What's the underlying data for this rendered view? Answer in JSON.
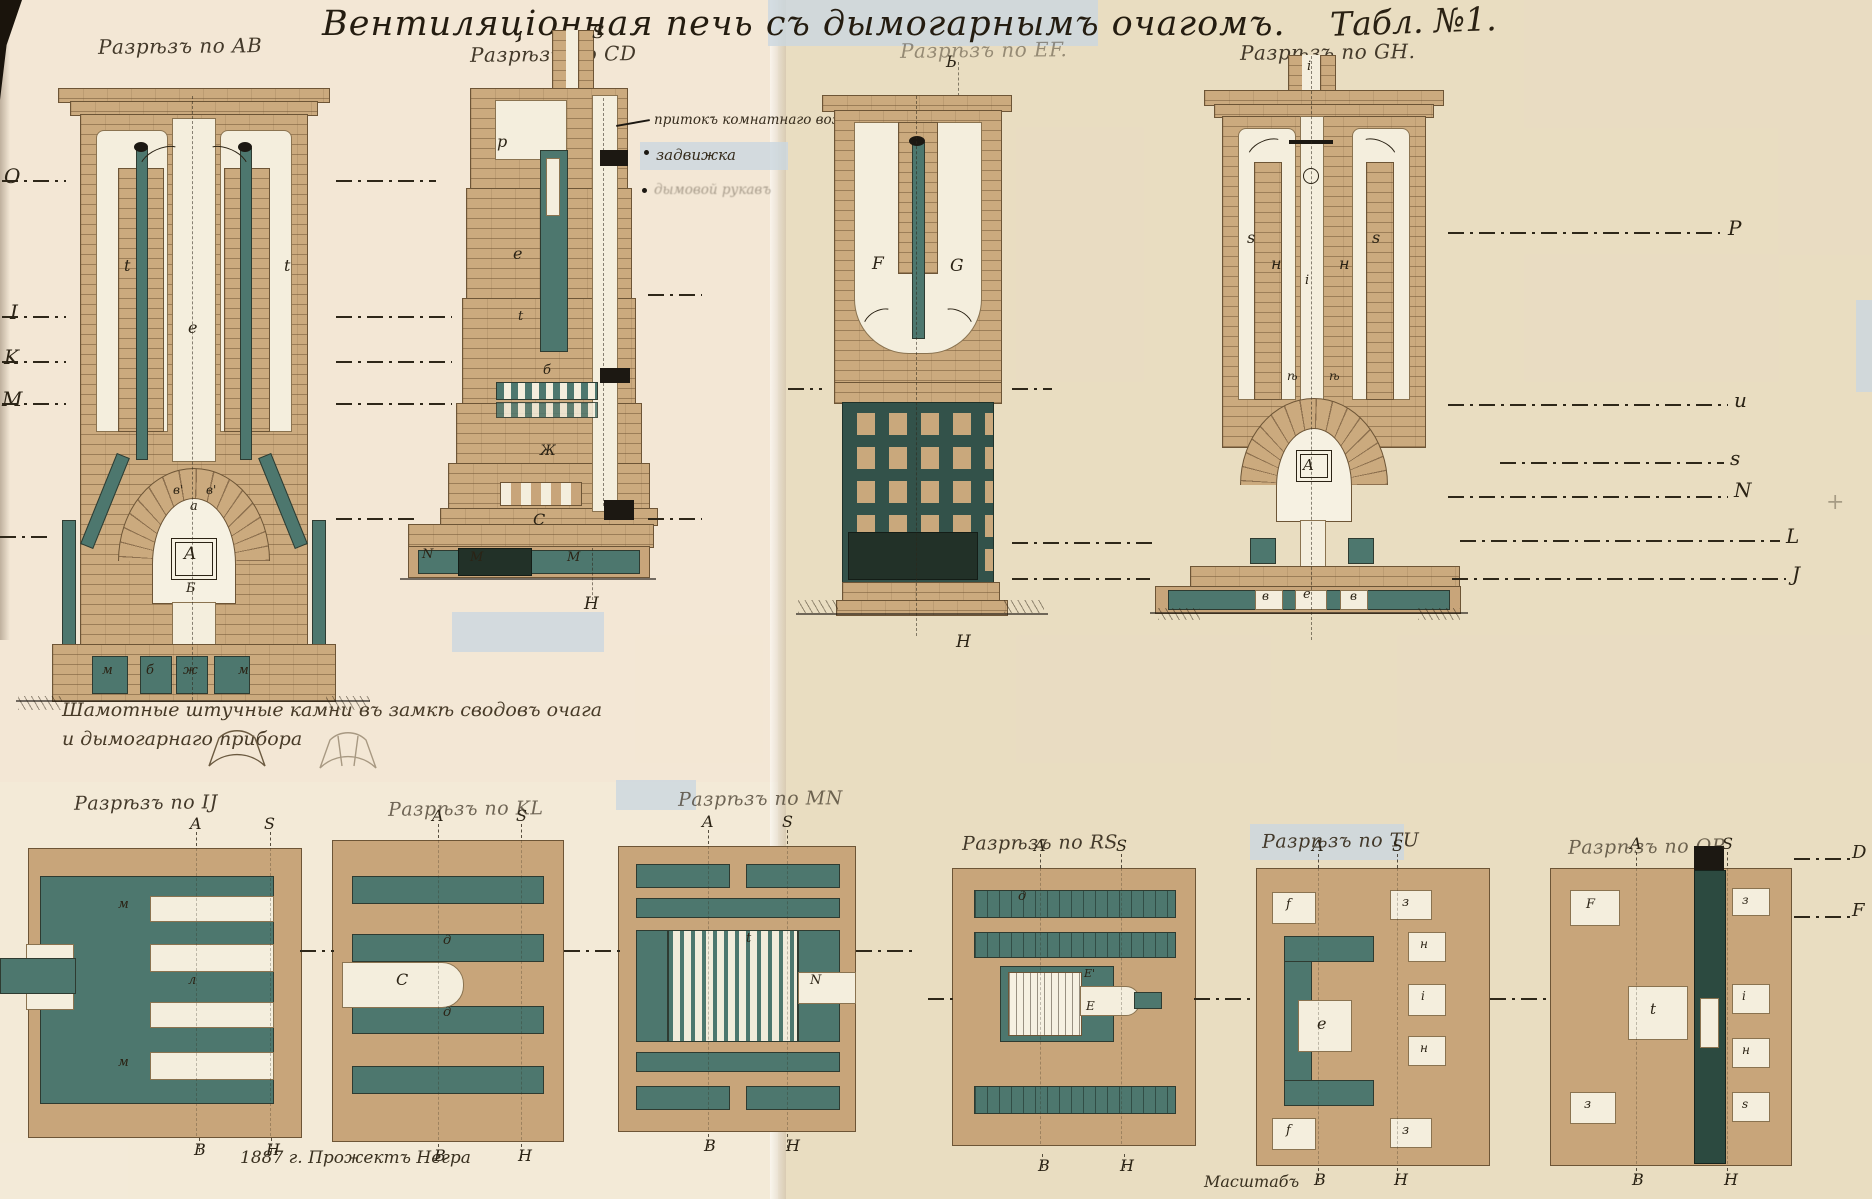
{
  "title": "Вентиляціонная печь съ дымогарнымъ очагомъ.",
  "plate": "Табл. №1.",
  "sections": {
    "ab": "Разрѣзъ по AB",
    "cd": "Разрѣзъ по CD",
    "ef": "Разрѣзъ по EF.",
    "gh": "Разрѣзъ по GH.",
    "ij": "Разрѣзъ по IJ",
    "kl": "Разрѣзъ по KL",
    "mn": "Разрѣзъ по MN",
    "rs": "Разрѣзъ по RS",
    "tu": "Разрѣзъ по TU",
    "op": "Разрѣзъ по OP"
  },
  "annotations": {
    "air_inlet": "притокъ комнатнаго воздуха",
    "damper": "задвижка",
    "smoke_duct": "дымовой рукавъ"
  },
  "notes": {
    "fireclay": "Шамотные штучные камни въ замкѣ сводовъ очага и дымогарнаго прибора",
    "credit": "1887 г. Прожектъ Негра",
    "scale": "Масштабъ"
  },
  "colors": {
    "paper": "#eee3cd",
    "brick": "#cbaa7e",
    "brick_line": "#6d5536",
    "flue_teal": "#4d776e",
    "dark_green": "#33524a",
    "near_black": "#1d2f27",
    "white_channel": "#f4eedd",
    "ink": "#2e2719",
    "highlight_blue": "#cad7e0"
  },
  "glyphs": [
    {
      "t": "O",
      "x": 4,
      "y": 166,
      "s": 20
    },
    {
      "t": "I",
      "x": 10,
      "y": 302,
      "s": 20
    },
    {
      "t": "K",
      "x": 4,
      "y": 347,
      "s": 20
    },
    {
      "t": "M",
      "x": 2,
      "y": 389,
      "s": 20
    },
    {
      "t": "P",
      "x": 1728,
      "y": 218,
      "s": 20
    },
    {
      "t": "u",
      "x": 1734,
      "y": 390,
      "s": 20
    },
    {
      "t": "s",
      "x": 1730,
      "y": 448,
      "s": 20
    },
    {
      "t": "N",
      "x": 1734,
      "y": 480,
      "s": 20
    },
    {
      "t": "L",
      "x": 1786,
      "y": 526,
      "s": 20
    },
    {
      "t": "J",
      "x": 1792,
      "y": 564,
      "s": 20
    },
    {
      "t": "+",
      "x": 1826,
      "y": 492,
      "s": 22,
      "o": 0.35
    },
    {
      "t": "D",
      "x": 1852,
      "y": 844,
      "s": 18
    },
    {
      "t": "F",
      "x": 1852,
      "y": 902,
      "s": 18
    },
    {
      "t": "t",
      "x": 124,
      "y": 258
    },
    {
      "t": "t",
      "x": 284,
      "y": 258
    },
    {
      "t": "е",
      "x": 188,
      "y": 320
    },
    {
      "t": "в'",
      "x": 173,
      "y": 484,
      "s": 12
    },
    {
      "t": "в'",
      "x": 206,
      "y": 484,
      "s": 12
    },
    {
      "t": "а",
      "x": 190,
      "y": 500,
      "s": 13
    },
    {
      "t": "A",
      "x": 184,
      "y": 546,
      "s": 17
    },
    {
      "t": "Б",
      "x": 186,
      "y": 582,
      "s": 13
    },
    {
      "t": "м",
      "x": 102,
      "y": 664,
      "s": 13
    },
    {
      "t": "б",
      "x": 146,
      "y": 664,
      "s": 13
    },
    {
      "t": "ж",
      "x": 183,
      "y": 664,
      "s": 13
    },
    {
      "t": "м",
      "x": 238,
      "y": 664,
      "s": 13
    },
    {
      "t": "S",
      "x": 592,
      "y": 24,
      "s": 18
    },
    {
      "t": "р",
      "x": 497,
      "y": 134
    },
    {
      "t": "е",
      "x": 513,
      "y": 246
    },
    {
      "t": "t",
      "x": 518,
      "y": 310,
      "s": 13
    },
    {
      "t": "б",
      "x": 543,
      "y": 364,
      "s": 13
    },
    {
      "t": "Ж",
      "x": 540,
      "y": 444,
      "s": 14
    },
    {
      "t": "С",
      "x": 533,
      "y": 512
    },
    {
      "t": "N",
      "x": 422,
      "y": 548,
      "s": 13
    },
    {
      "t": "М",
      "x": 470,
      "y": 551,
      "s": 13
    },
    {
      "t": "М",
      "x": 567,
      "y": 551,
      "s": 13
    },
    {
      "t": "Н",
      "x": 584,
      "y": 596,
      "s": 17
    },
    {
      "t": "Ь",
      "x": 946,
      "y": 54
    },
    {
      "t": "F",
      "x": 872,
      "y": 256,
      "s": 17
    },
    {
      "t": "G",
      "x": 950,
      "y": 258,
      "s": 17
    },
    {
      "t": "Н",
      "x": 956,
      "y": 634,
      "s": 17
    },
    {
      "t": "i",
      "x": 1307,
      "y": 60,
      "s": 13
    },
    {
      "t": "s",
      "x": 1247,
      "y": 230
    },
    {
      "t": "н",
      "x": 1271,
      "y": 256
    },
    {
      "t": "i",
      "x": 1305,
      "y": 274,
      "s": 13
    },
    {
      "t": "н",
      "x": 1339,
      "y": 256
    },
    {
      "t": "s",
      "x": 1372,
      "y": 230
    },
    {
      "t": "ѣ",
      "x": 1287,
      "y": 370,
      "s": 12
    },
    {
      "t": "ѣ",
      "x": 1329,
      "y": 370,
      "s": 12
    },
    {
      "t": "A",
      "x": 1303,
      "y": 458,
      "s": 15
    },
    {
      "t": "в",
      "x": 1262,
      "y": 590,
      "s": 12
    },
    {
      "t": "е",
      "x": 1303,
      "y": 588,
      "s": 13
    },
    {
      "t": "в",
      "x": 1350,
      "y": 590,
      "s": 12
    },
    {
      "t": "м",
      "x": 118,
      "y": 898,
      "s": 13
    },
    {
      "t": "м",
      "x": 118,
      "y": 1056,
      "s": 13
    },
    {
      "t": "л",
      "x": 188,
      "y": 974,
      "s": 13
    },
    {
      "t": "A",
      "x": 190,
      "y": 816
    },
    {
      "t": "S",
      "x": 264,
      "y": 816
    },
    {
      "t": "В",
      "x": 194,
      "y": 1142
    },
    {
      "t": "Н",
      "x": 266,
      "y": 1142
    },
    {
      "t": "д",
      "x": 443,
      "y": 934,
      "s": 13
    },
    {
      "t": "С",
      "x": 396,
      "y": 972
    },
    {
      "t": "д",
      "x": 443,
      "y": 1006,
      "s": 13
    },
    {
      "t": "A",
      "x": 432,
      "y": 808
    },
    {
      "t": "S",
      "x": 516,
      "y": 808
    },
    {
      "t": "В",
      "x": 434,
      "y": 1148
    },
    {
      "t": "Н",
      "x": 518,
      "y": 1148
    },
    {
      "t": "t",
      "x": 746,
      "y": 932,
      "s": 13
    },
    {
      "t": "N",
      "x": 810,
      "y": 974,
      "s": 13
    },
    {
      "t": "A",
      "x": 702,
      "y": 814
    },
    {
      "t": "S",
      "x": 782,
      "y": 814
    },
    {
      "t": "В",
      "x": 704,
      "y": 1138
    },
    {
      "t": "Н",
      "x": 786,
      "y": 1138
    },
    {
      "t": "д",
      "x": 1018,
      "y": 890,
      "s": 13
    },
    {
      "t": "Е'",
      "x": 1084,
      "y": 968,
      "s": 11
    },
    {
      "t": "Е",
      "x": 1086,
      "y": 1000,
      "s": 12
    },
    {
      "t": "A",
      "x": 1034,
      "y": 838
    },
    {
      "t": "S",
      "x": 1116,
      "y": 838
    },
    {
      "t": "В",
      "x": 1038,
      "y": 1158
    },
    {
      "t": "Н",
      "x": 1120,
      "y": 1158
    },
    {
      "t": "f",
      "x": 1286,
      "y": 898,
      "s": 13
    },
    {
      "t": "з",
      "x": 1402,
      "y": 896,
      "s": 13
    },
    {
      "t": "н",
      "x": 1420,
      "y": 938,
      "s": 12
    },
    {
      "t": "i",
      "x": 1421,
      "y": 990,
      "s": 12
    },
    {
      "t": "н",
      "x": 1420,
      "y": 1042,
      "s": 12
    },
    {
      "t": "е",
      "x": 1317,
      "y": 1016
    },
    {
      "t": "f",
      "x": 1286,
      "y": 1124,
      "s": 13
    },
    {
      "t": "з",
      "x": 1402,
      "y": 1124,
      "s": 13
    },
    {
      "t": "A",
      "x": 1312,
      "y": 838
    },
    {
      "t": "S",
      "x": 1392,
      "y": 838
    },
    {
      "t": "В",
      "x": 1314,
      "y": 1172
    },
    {
      "t": "Н",
      "x": 1394,
      "y": 1172
    },
    {
      "t": "F",
      "x": 1586,
      "y": 898,
      "s": 13
    },
    {
      "t": "з",
      "x": 1742,
      "y": 894,
      "s": 12
    },
    {
      "t": "t",
      "x": 1650,
      "y": 1002,
      "s": 15
    },
    {
      "t": "i",
      "x": 1742,
      "y": 990,
      "s": 12
    },
    {
      "t": "н",
      "x": 1742,
      "y": 1044,
      "s": 12
    },
    {
      "t": "s",
      "x": 1742,
      "y": 1098,
      "s": 12
    },
    {
      "t": "з",
      "x": 1584,
      "y": 1098,
      "s": 13
    },
    {
      "t": "A",
      "x": 1630,
      "y": 836
    },
    {
      "t": "S",
      "x": 1722,
      "y": 836
    },
    {
      "t": "В",
      "x": 1632,
      "y": 1172
    },
    {
      "t": "Н",
      "x": 1724,
      "y": 1172
    }
  ]
}
